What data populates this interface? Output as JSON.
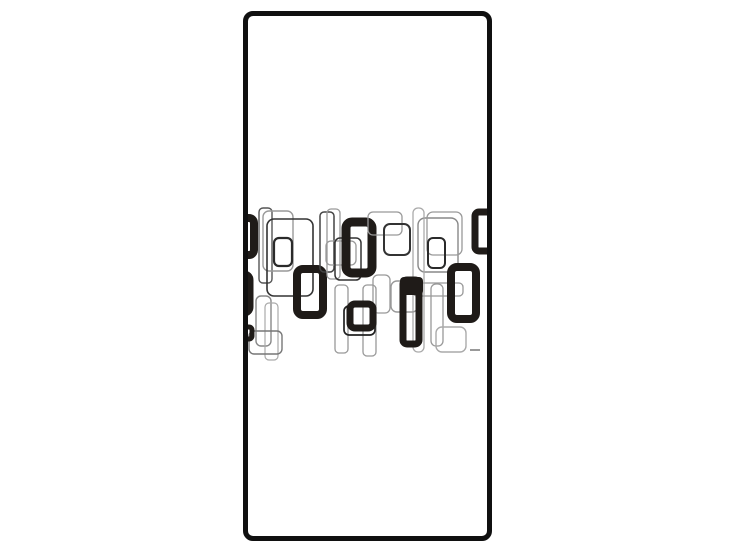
{
  "scene": {
    "description": "Tall white rectangular panel (furniture/door front) with black rounded border containing a horizontal band of overlapping retro rounded-rectangle shapes, on a plain white background",
    "background_color": "#ffffff"
  },
  "panel": {
    "fill_color": "#ffffff",
    "border_color": "#101010",
    "geometry": {
      "left": 243,
      "top": 11,
      "width": 249,
      "height": 530,
      "border": 5,
      "radius": 10
    }
  },
  "pattern": {
    "ink_color": "#1f1b18",
    "band": {
      "left": 0,
      "top": 184,
      "width": 239,
      "height": 162,
      "viewBox": "248 200 239 162"
    },
    "shapes": [
      {
        "kind": "ring",
        "x": 230,
        "y": 218,
        "w": 24,
        "h": 37,
        "r": 5,
        "sw": 8
      },
      {
        "kind": "ring",
        "x": 224,
        "y": 275,
        "w": 25,
        "h": 37,
        "r": 5,
        "sw": 9
      },
      {
        "kind": "outline",
        "x": 259,
        "y": 208,
        "w": 13,
        "h": 75,
        "r": 4,
        "sw": 1.4,
        "c": "#555555"
      },
      {
        "kind": "outline",
        "x": 263,
        "y": 211,
        "w": 30,
        "h": 60,
        "r": 6,
        "sw": 1.4,
        "c": "#999999"
      },
      {
        "kind": "outline",
        "x": 267,
        "y": 219,
        "w": 46,
        "h": 77,
        "r": 7,
        "sw": 1.6,
        "c": "#333333"
      },
      {
        "kind": "outline",
        "x": 274,
        "y": 238,
        "w": 18,
        "h": 28,
        "r": 5,
        "sw": 2.2,
        "c": "#2a2a2a"
      },
      {
        "kind": "ring",
        "x": 297,
        "y": 269,
        "w": 26,
        "h": 46,
        "r": 6,
        "sw": 8
      },
      {
        "kind": "outline",
        "x": 320,
        "y": 212,
        "w": 14,
        "h": 60,
        "r": 4,
        "sw": 1.5,
        "c": "#444444"
      },
      {
        "kind": "outline",
        "x": 327,
        "y": 209,
        "w": 13,
        "h": 70,
        "r": 4,
        "sw": 1.3,
        "c": "#999999"
      },
      {
        "kind": "outline",
        "x": 326,
        "y": 241,
        "w": 30,
        "h": 24,
        "r": 5,
        "sw": 1.3,
        "c": "#999999"
      },
      {
        "kind": "outline",
        "x": 335,
        "y": 238,
        "w": 26,
        "h": 42,
        "r": 5,
        "sw": 1.5,
        "c": "#333333"
      },
      {
        "kind": "ring",
        "x": 346,
        "y": 222,
        "w": 26,
        "h": 51,
        "r": 6,
        "sw": 9
      },
      {
        "kind": "outline",
        "x": 368,
        "y": 212,
        "w": 34,
        "h": 23,
        "r": 5,
        "sw": 1.3,
        "c": "#999999"
      },
      {
        "kind": "outline",
        "x": 384,
        "y": 224,
        "w": 26,
        "h": 31,
        "r": 6,
        "sw": 2,
        "c": "#333333"
      },
      {
        "kind": "outline",
        "x": 418,
        "y": 218,
        "w": 40,
        "h": 54,
        "r": 7,
        "sw": 1.4,
        "c": "#888888"
      },
      {
        "kind": "outline",
        "x": 427,
        "y": 212,
        "w": 35,
        "h": 43,
        "r": 6,
        "sw": 1.3,
        "c": "#999999"
      },
      {
        "kind": "outline",
        "x": 428,
        "y": 238,
        "w": 17,
        "h": 30,
        "r": 5,
        "sw": 2,
        "c": "#2a2a2a"
      },
      {
        "kind": "ring",
        "x": 475,
        "y": 212,
        "w": 18,
        "h": 39,
        "r": 4,
        "sw": 7
      },
      {
        "kind": "outline",
        "x": 413,
        "y": 208,
        "w": 11,
        "h": 144,
        "r": 5,
        "sw": 1.3,
        "c": "#aaaaaa"
      },
      {
        "kind": "outline",
        "x": 373,
        "y": 275,
        "w": 17,
        "h": 38,
        "r": 5,
        "sw": 1.3,
        "c": "#999999"
      },
      {
        "kind": "outline",
        "x": 391,
        "y": 281,
        "w": 27,
        "h": 31,
        "r": 6,
        "sw": 1.4,
        "c": "#999999"
      },
      {
        "kind": "outline",
        "x": 413,
        "y": 283,
        "w": 50,
        "h": 13,
        "r": 4,
        "sw": 1.3,
        "c": "#999999"
      },
      {
        "kind": "fill",
        "x": 400,
        "y": 277,
        "w": 23,
        "h": 18,
        "r": 4
      },
      {
        "kind": "ring",
        "x": 403,
        "y": 280,
        "w": 16,
        "h": 64,
        "r": 4,
        "sw": 7
      },
      {
        "kind": "ring",
        "x": 451,
        "y": 267,
        "w": 25,
        "h": 52,
        "r": 6,
        "sw": 8
      },
      {
        "kind": "outline",
        "x": 335,
        "y": 285,
        "w": 13,
        "h": 68,
        "r": 4,
        "sw": 1.3,
        "c": "#999999"
      },
      {
        "kind": "outline",
        "x": 363,
        "y": 285,
        "w": 13,
        "h": 71,
        "r": 4,
        "sw": 1.3,
        "c": "#999999"
      },
      {
        "kind": "outline",
        "x": 344,
        "y": 306,
        "w": 31,
        "h": 29,
        "r": 5,
        "sw": 1.7,
        "c": "#222222"
      },
      {
        "kind": "ring",
        "x": 350,
        "y": 304,
        "w": 23,
        "h": 24,
        "r": 5,
        "sw": 7
      },
      {
        "kind": "outline",
        "x": 431,
        "y": 284,
        "w": 12,
        "h": 62,
        "r": 5,
        "sw": 1.3,
        "c": "#999999"
      },
      {
        "kind": "outline",
        "x": 436,
        "y": 327,
        "w": 30,
        "h": 25,
        "r": 6,
        "sw": 1.4,
        "c": "#aaaaaa"
      },
      {
        "kind": "outline",
        "x": 256,
        "y": 296,
        "w": 15,
        "h": 50,
        "r": 5,
        "sw": 1.4,
        "c": "#888888"
      },
      {
        "kind": "outline",
        "x": 265,
        "y": 303,
        "w": 13,
        "h": 57,
        "r": 4,
        "sw": 1.2,
        "c": "#aaaaaa"
      },
      {
        "kind": "outline",
        "x": 249,
        "y": 331,
        "w": 33,
        "h": 23,
        "r": 5,
        "sw": 1.4,
        "c": "#777777"
      },
      {
        "kind": "ring",
        "x": 238,
        "y": 327,
        "w": 14,
        "h": 12,
        "r": 3,
        "sw": 5
      },
      {
        "kind": "dash",
        "x": 470,
        "y": 349,
        "w": 10,
        "h": 2,
        "r": 0,
        "c": "#999999"
      }
    ]
  }
}
